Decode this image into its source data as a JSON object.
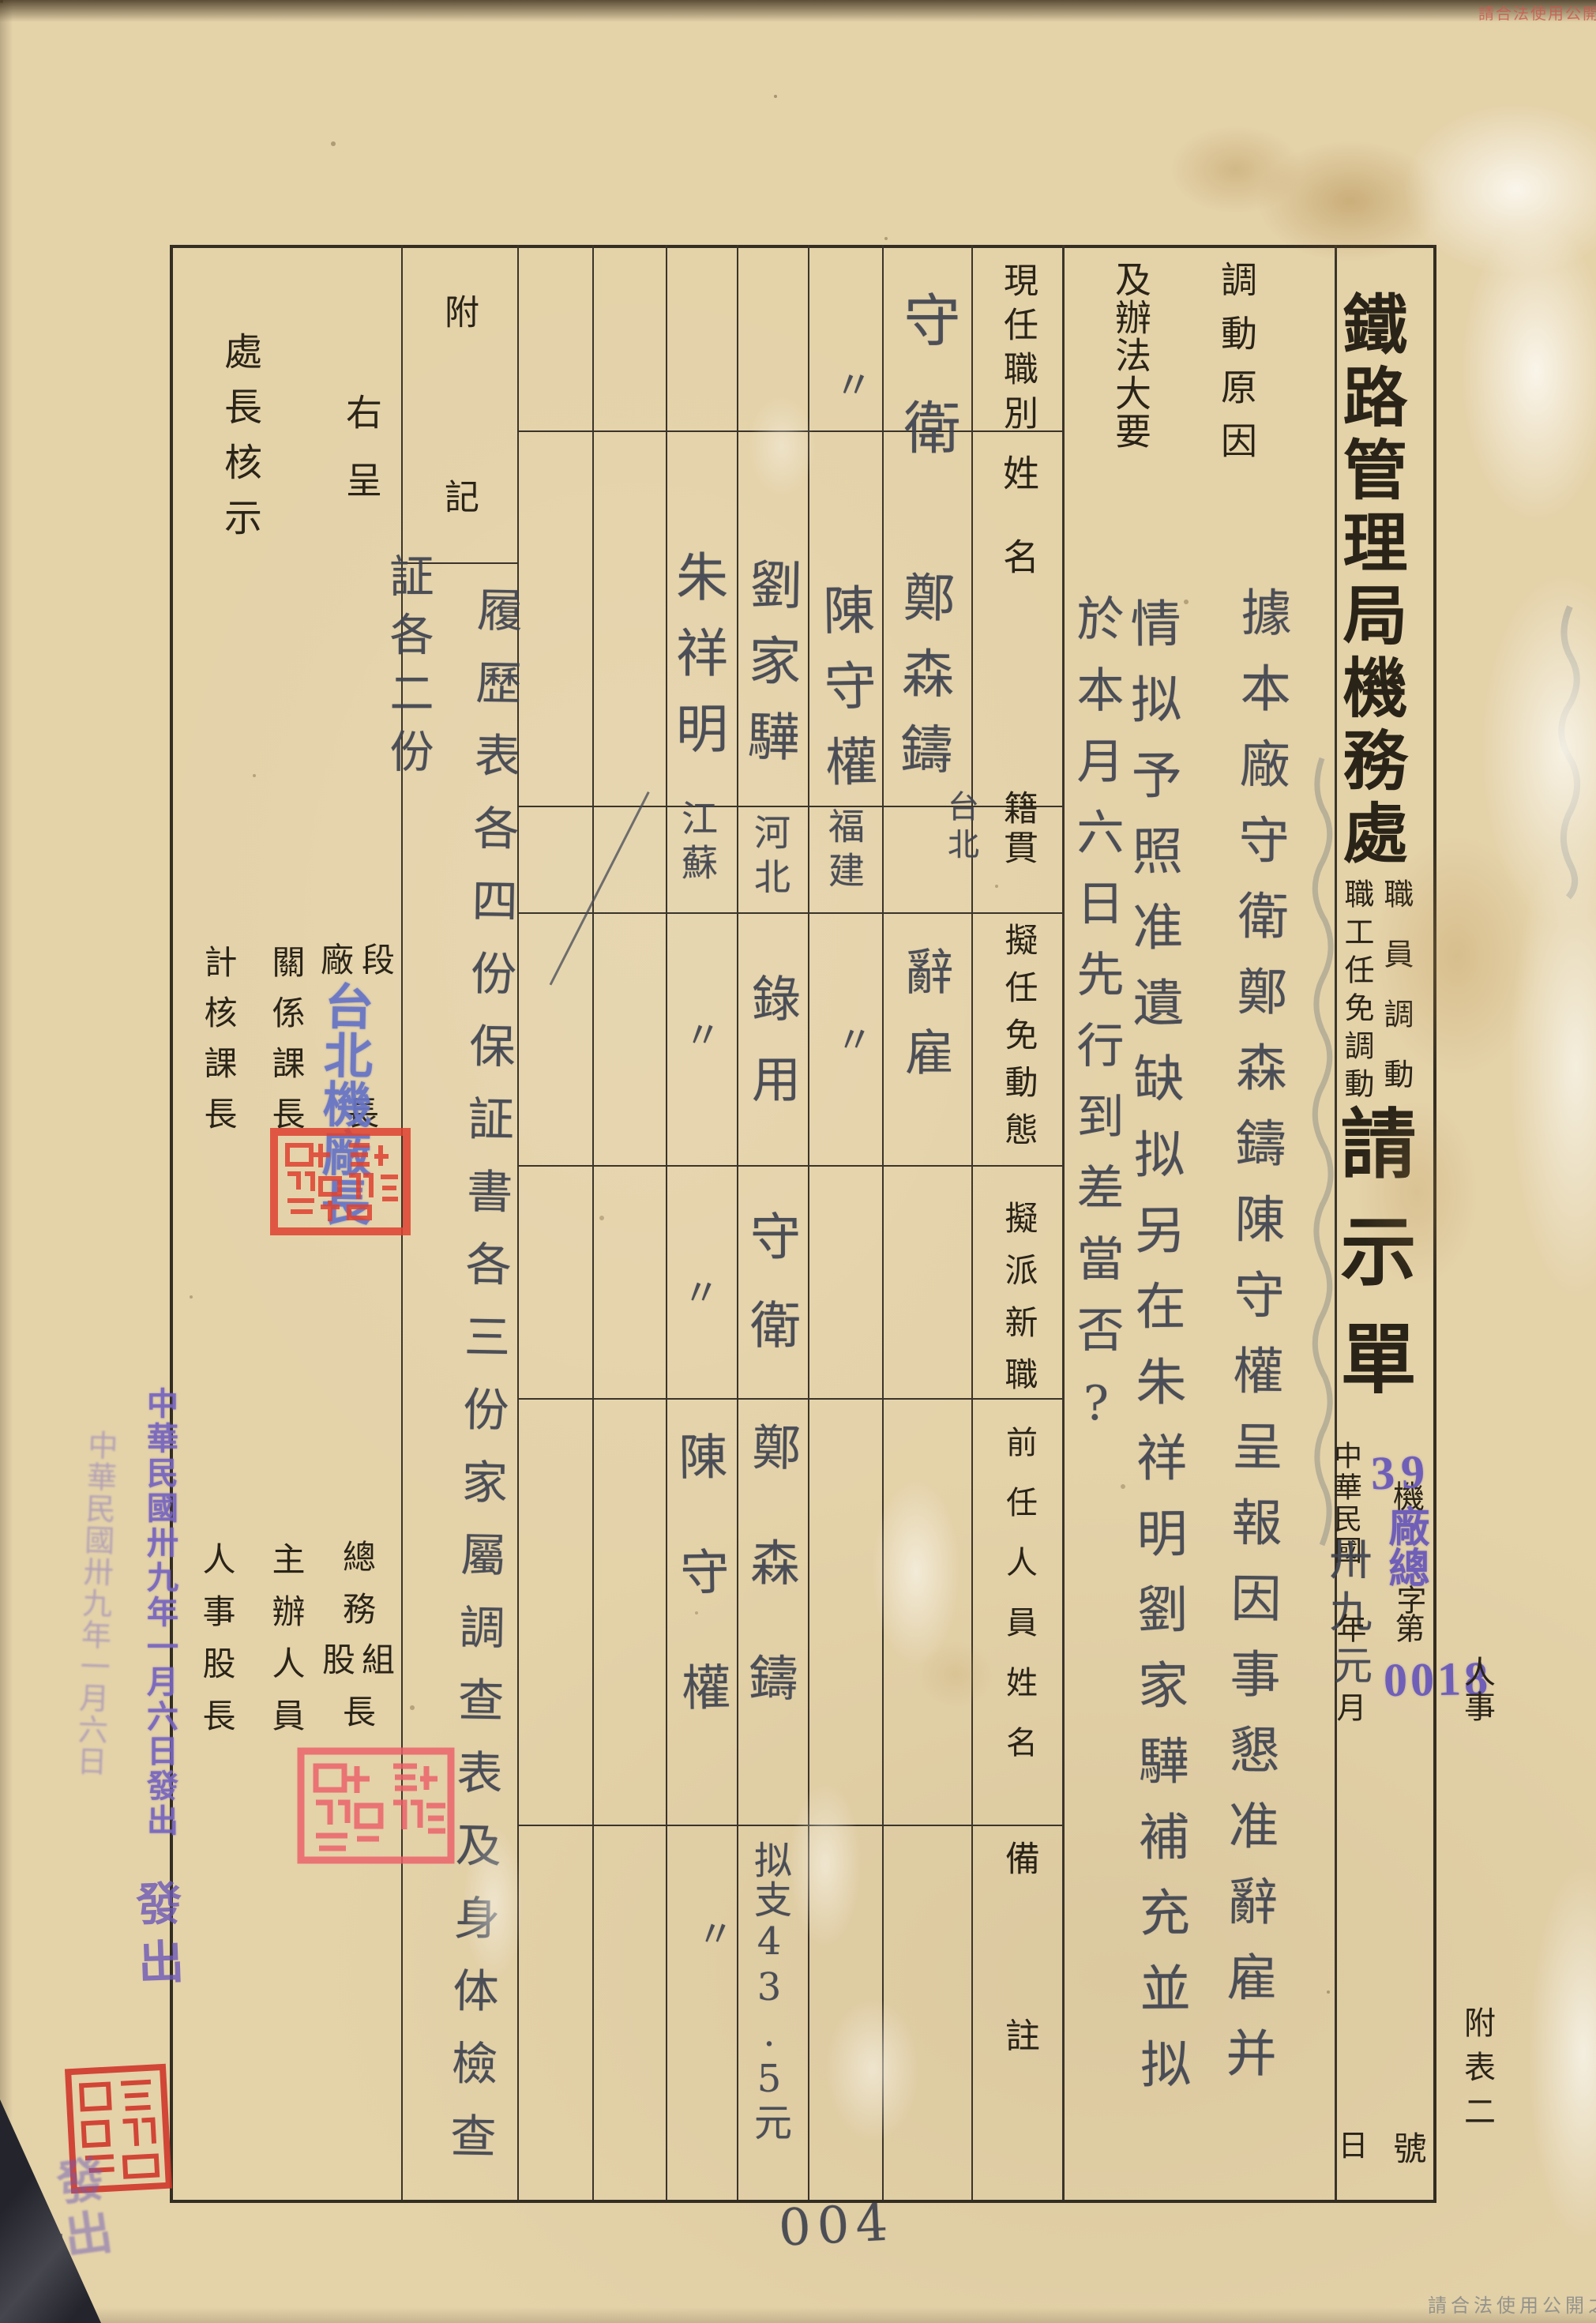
{
  "page": {
    "page_number": "004",
    "watermark_bottom": "請合法使用公開之影像",
    "watermark_top": "請合法使用公開之影像",
    "margin_label_top": "人事",
    "margin_label_bottom": "附表二"
  },
  "header": {
    "org_title": "鐵路管理局機務處",
    "subtitle_right": "職員調動",
    "subtitle_left": "職工任免調動",
    "title_tail": "請示單",
    "date": {
      "era": "中華民國",
      "year_hw": "卅九",
      "year_unit": "年",
      "month_hw": "元",
      "month_unit": "月",
      "day_unit": "日"
    },
    "doc_no": {
      "prefix": "機",
      "stamp_mid": "廠總",
      "zi": "字",
      "di": "第",
      "stamp_year": "39",
      "stamp_serial": "0018",
      "suffix": "號"
    }
  },
  "table": {
    "col_reason_h1": "調動原因",
    "col_reason_h2": "及辦法大要",
    "reason_lines": [
      "據本廠守衛鄭森鑄陳守權呈報因事懇准辭雇并",
      "情拟予照准遺缺拟另在朱祥明劉家驊補充並拟",
      "於本月六日先行到差當否?"
    ],
    "row_headers": {
      "current_title": "現任職別",
      "name": "姓名",
      "native_place": "籍貫",
      "action": "擬任免動態",
      "new_post": "擬派新職",
      "predecessor": "前任人員姓名",
      "remarks": "備註"
    },
    "persons": [
      {
        "current_title": "守衛",
        "name": "鄭森鑄",
        "native_place": "台北",
        "action": "辭雇",
        "new_post": "",
        "predecessor": "",
        "remarks": ""
      },
      {
        "current_title": "〃",
        "name": "陳守權",
        "native_place": "福建",
        "action": "〃",
        "new_post": "",
        "predecessor": "",
        "remarks": ""
      },
      {
        "current_title": "",
        "name": "劉家驊",
        "native_place": "河北",
        "action": "錄用",
        "new_post": "守衛",
        "predecessor": "鄭森鑄",
        "remarks": "拟支43.5元"
      },
      {
        "current_title": "",
        "name": "朱祥明",
        "native_place": "江蘇",
        "action": "〃",
        "new_post": "〃",
        "predecessor": "陳守權",
        "remarks": "〃"
      }
    ]
  },
  "notes": {
    "header": "附記",
    "line1": "履歷表各四份保証書各三份家屬調查表及身体檢查",
    "line2": "証各二份"
  },
  "left": {
    "submit_label": "右呈",
    "review_label": "處長核示",
    "sig_a_right": "段",
    "sig_a_left": "廠",
    "sig_a_bottom": "長",
    "sig_b": "關係課長",
    "sig_c": "計核課長",
    "sig_d_top1": "總",
    "sig_d_top2": "務",
    "sig_d_left": "股",
    "sig_d_right": "組",
    "sig_d_bottom": "長",
    "sig_e": "主辦人員",
    "sig_f": "人事股長"
  },
  "stamps": {
    "factory_chief": "台北機廠長",
    "date_stamp": "中華民國卅九年一月六日發出",
    "date_stamp_ghost": "中華民國卅九年一月六日",
    "issue_marks": "發出",
    "issue_marks_ghost": "發出"
  }
}
